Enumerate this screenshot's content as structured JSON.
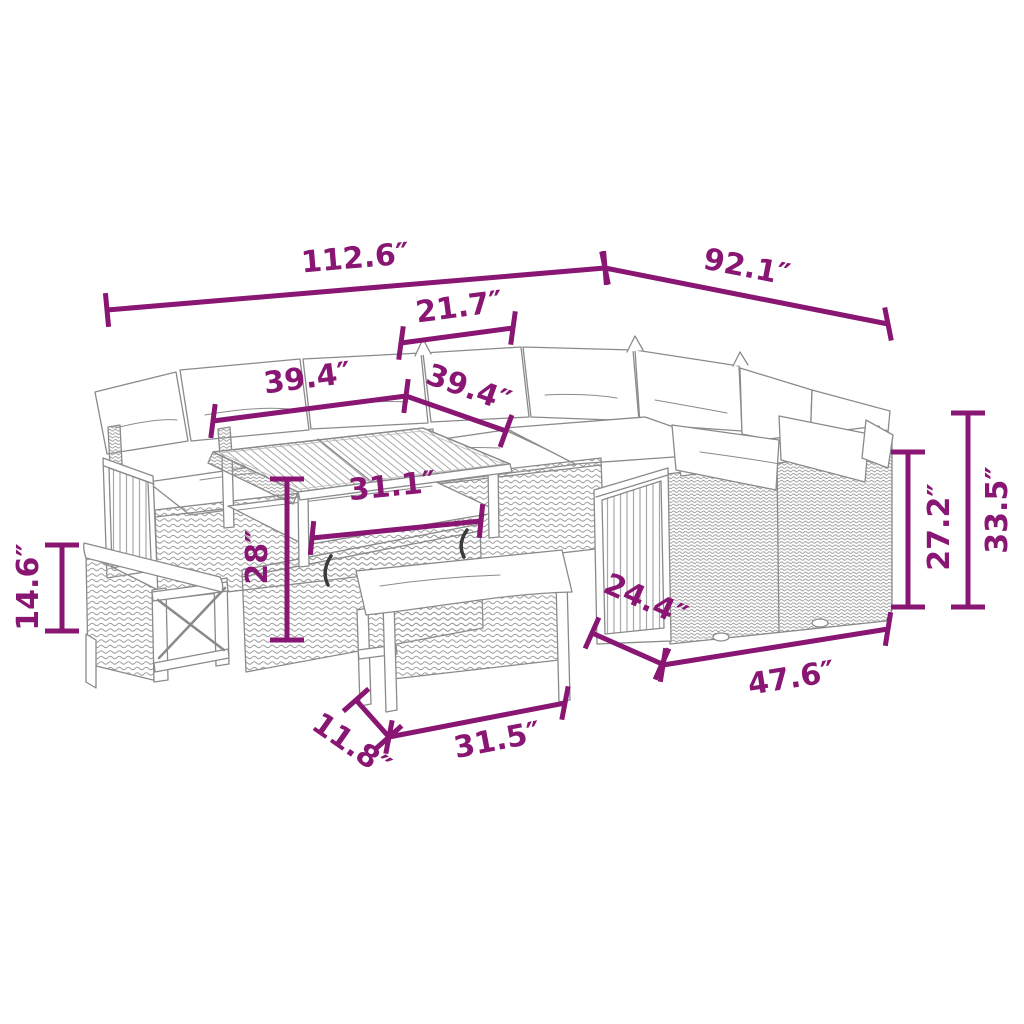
{
  "figure": {
    "type": "product-dimension-diagram",
    "subject": "Outdoor poly rattan lounge set with corner sofa, storage table and benches",
    "unit": "inches"
  },
  "colors": {
    "dimension": "#881672",
    "linework": "#8a8a8a",
    "background": "#ffffff",
    "cushion": "#ffffff",
    "hook": "#3a3a3a"
  },
  "dimensions": [
    {
      "id": "overall-width",
      "label": "112.6″",
      "value": 112.6
    },
    {
      "id": "overall-depth",
      "label": "92.1″",
      "value": 92.1
    },
    {
      "id": "corner-section-width",
      "label": "21.7″",
      "value": 21.7
    },
    {
      "id": "table-length",
      "label": "39.4″",
      "value": 39.4
    },
    {
      "id": "table-width",
      "label": "39.4″",
      "value": 39.4
    },
    {
      "id": "table-inner-width",
      "label": "31.1″",
      "value": 31.1
    },
    {
      "id": "table-height",
      "label": "28″",
      "value": 28
    },
    {
      "id": "bench-height",
      "label": "14.6″",
      "value": 14.6
    },
    {
      "id": "sofa-back-height",
      "label": "27.2″",
      "value": 27.2
    },
    {
      "id": "sofa-total-height",
      "label": "33.5″",
      "value": 33.5
    },
    {
      "id": "sofa-depth",
      "label": "24.4″",
      "value": 24.4
    },
    {
      "id": "sofa-length",
      "label": "47.6″",
      "value": 47.6
    },
    {
      "id": "bench-depth",
      "label": "11.8″",
      "value": 11.8
    },
    {
      "id": "bench-length",
      "label": "31.5″",
      "value": 31.5
    }
  ]
}
